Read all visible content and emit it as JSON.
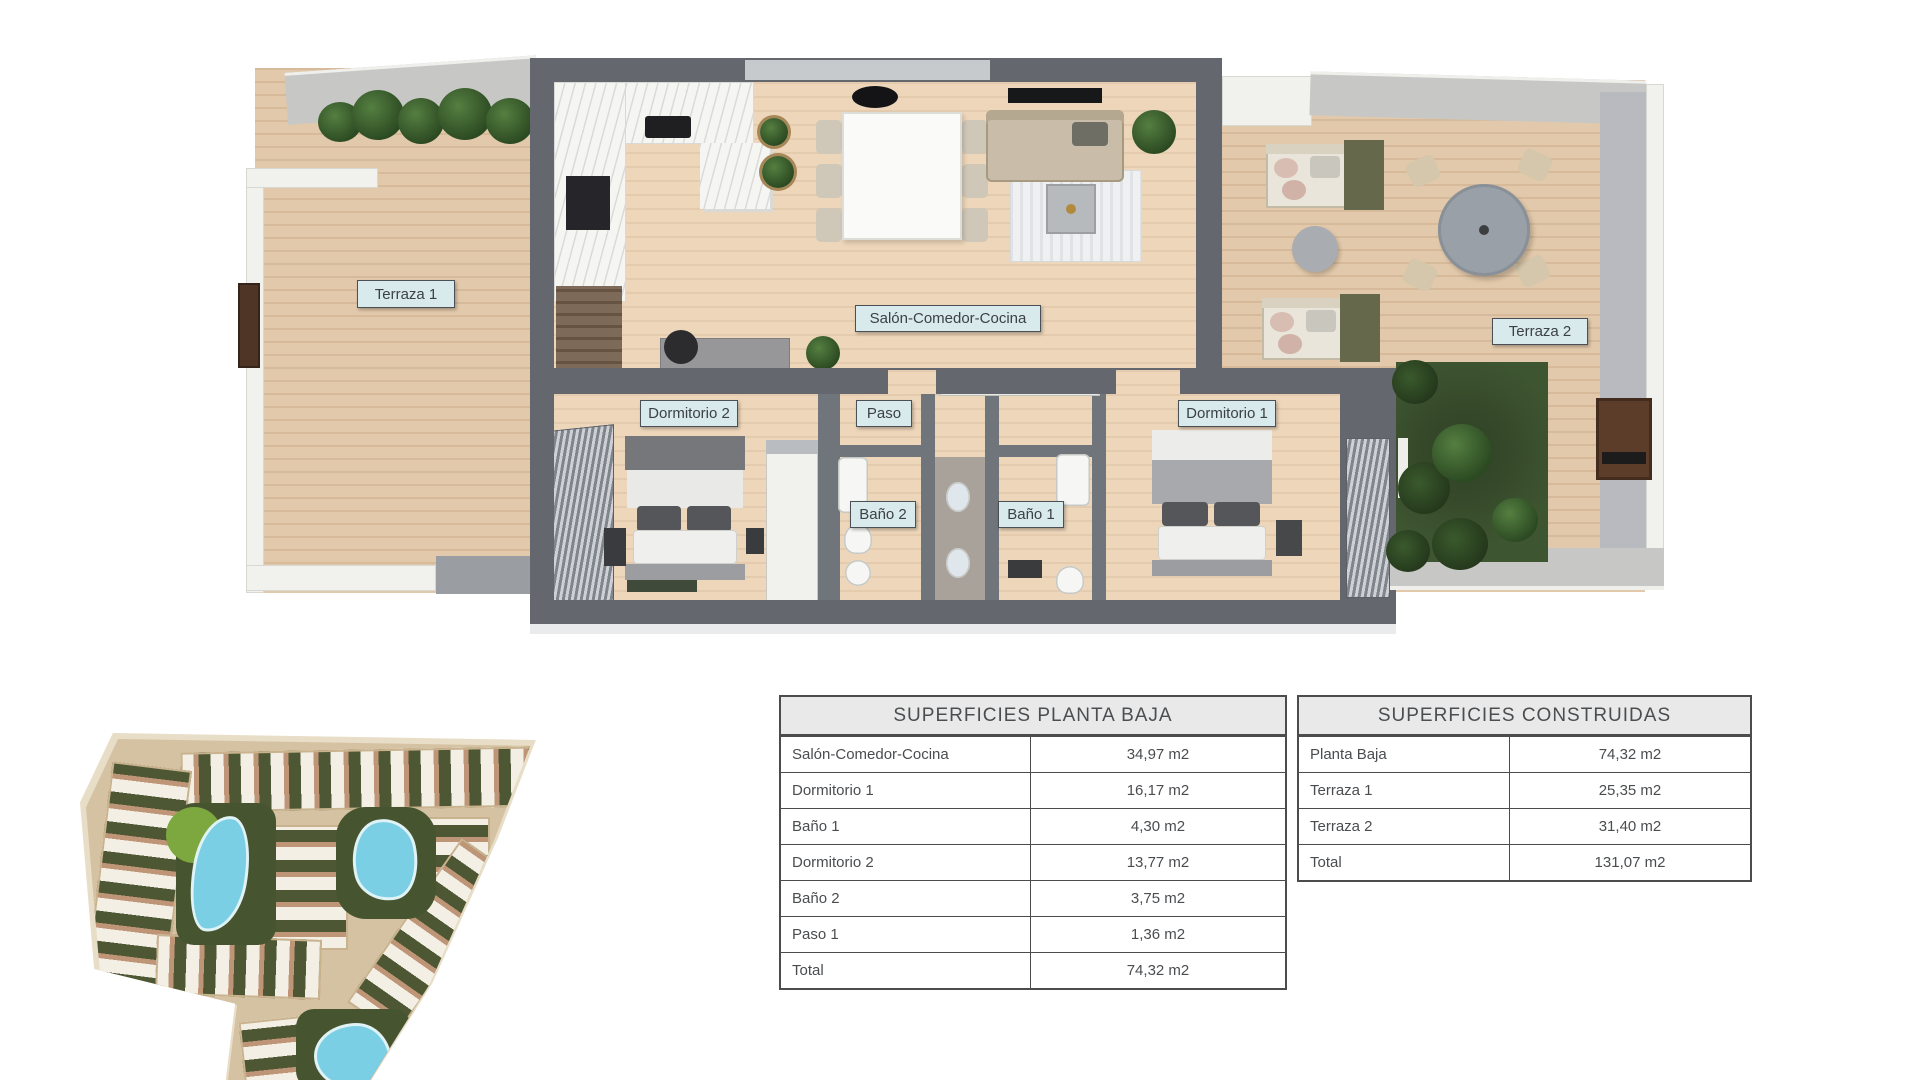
{
  "floorplan": {
    "labels": {
      "terraza1": "Terraza 1",
      "salon": "Salón-Comedor-Cocina",
      "terraza2": "Terraza 2",
      "dormitorio2": "Dormitorio 2",
      "paso": "Paso",
      "dormitorio1": "Dormitorio 1",
      "bano2": "Baño 2",
      "bano1": "Baño 1"
    },
    "label_colors": {
      "background": "#d9eaec",
      "border": "#4a5055",
      "text": "#3b4145"
    }
  },
  "tables": {
    "planta_baja": {
      "title": "SUPERFICIES PLANTA BAJA",
      "rows": [
        {
          "label": "Salón-Comedor-Cocina",
          "value": "34,97 m2"
        },
        {
          "label": "Dormitorio 1",
          "value": "16,17 m2"
        },
        {
          "label": "Baño 1",
          "value": "4,30 m2"
        },
        {
          "label": "Dormitorio 2",
          "value": "13,77 m2"
        },
        {
          "label": "Baño 2",
          "value": "3,75 m2"
        },
        {
          "label": "Paso 1",
          "value": "1,36 m2"
        },
        {
          "label": "Total",
          "value": "74,32 m2"
        }
      ]
    },
    "construidas": {
      "title": "SUPERFICIES CONSTRUIDAS",
      "rows": [
        {
          "label": "Planta Baja",
          "value": "74,32 m2"
        },
        {
          "label": "Terraza 1",
          "value": "25,35 m2"
        },
        {
          "label": "Terraza 2",
          "value": "31,40 m2"
        },
        {
          "label": "Total",
          "value": "131,07 m2"
        }
      ]
    }
  }
}
